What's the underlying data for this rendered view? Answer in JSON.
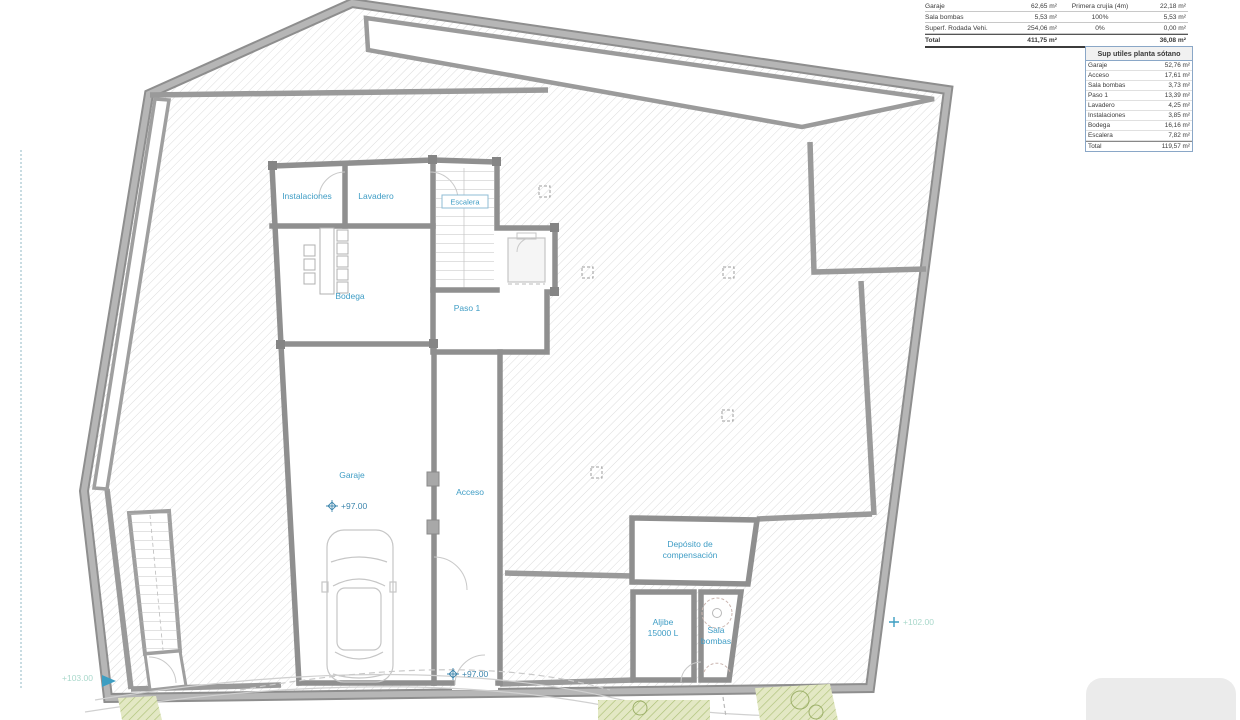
{
  "tables": {
    "computo": {
      "rows": [
        [
          "Garaje",
          "62,65 m²",
          "Primera crujía (4m)",
          "22,18 m²"
        ],
        [
          "Sala bombas",
          "5,53 m²",
          "100%",
          "5,53 m²"
        ],
        [
          "Superf. Rodada Vehi.",
          "254,06 m²",
          "0%",
          "0,00 m²"
        ],
        [
          "Total",
          "411,75 m²",
          "",
          "36,08 m²"
        ]
      ]
    },
    "sup_utiles": {
      "title": "Sup utiles planta sótano",
      "rows": [
        [
          "Garaje",
          "52,76 m²"
        ],
        [
          "Acceso",
          "17,61 m²"
        ],
        [
          "Sala bombas",
          "3,73 m²"
        ],
        [
          "Paso 1",
          "13,39 m²"
        ],
        [
          "Lavadero",
          "4,25 m²"
        ],
        [
          "Instalaciones",
          "3,85 m²"
        ],
        [
          "Bodega",
          "16,16 m²"
        ],
        [
          "Escalera",
          "7,82 m²"
        ],
        [
          "Total",
          "119,57 m²"
        ]
      ]
    }
  },
  "plan": {
    "room_labels": {
      "instalaciones": "Instalaciones",
      "lavadero": "Lavadero",
      "escalera": "Escalera",
      "bodega": "Bodega",
      "paso1": "Paso 1",
      "garaje": "Garaje",
      "acceso": "Acceso",
      "deposito_1": "Depósito de",
      "deposito_2": "compensación",
      "aljibe_1": "Aljibe",
      "aljibe_2": "15000 L",
      "sala_1": "Sala",
      "sala_2": "bombas"
    },
    "elevations": {
      "garaje": "+97.00",
      "acceso": "+97.00",
      "terrain_right": "+102.00",
      "terrain_left": "+103.00"
    }
  },
  "colors": {
    "label_blue": "#3f9dc5",
    "wall_gray": "#9a9a9a",
    "elevation_pale": "#a9d8cb",
    "marker_teal": "#3d9ec2",
    "table_border_blue": "#8aa7c7",
    "vegetation_green": "#b5c48a"
  }
}
